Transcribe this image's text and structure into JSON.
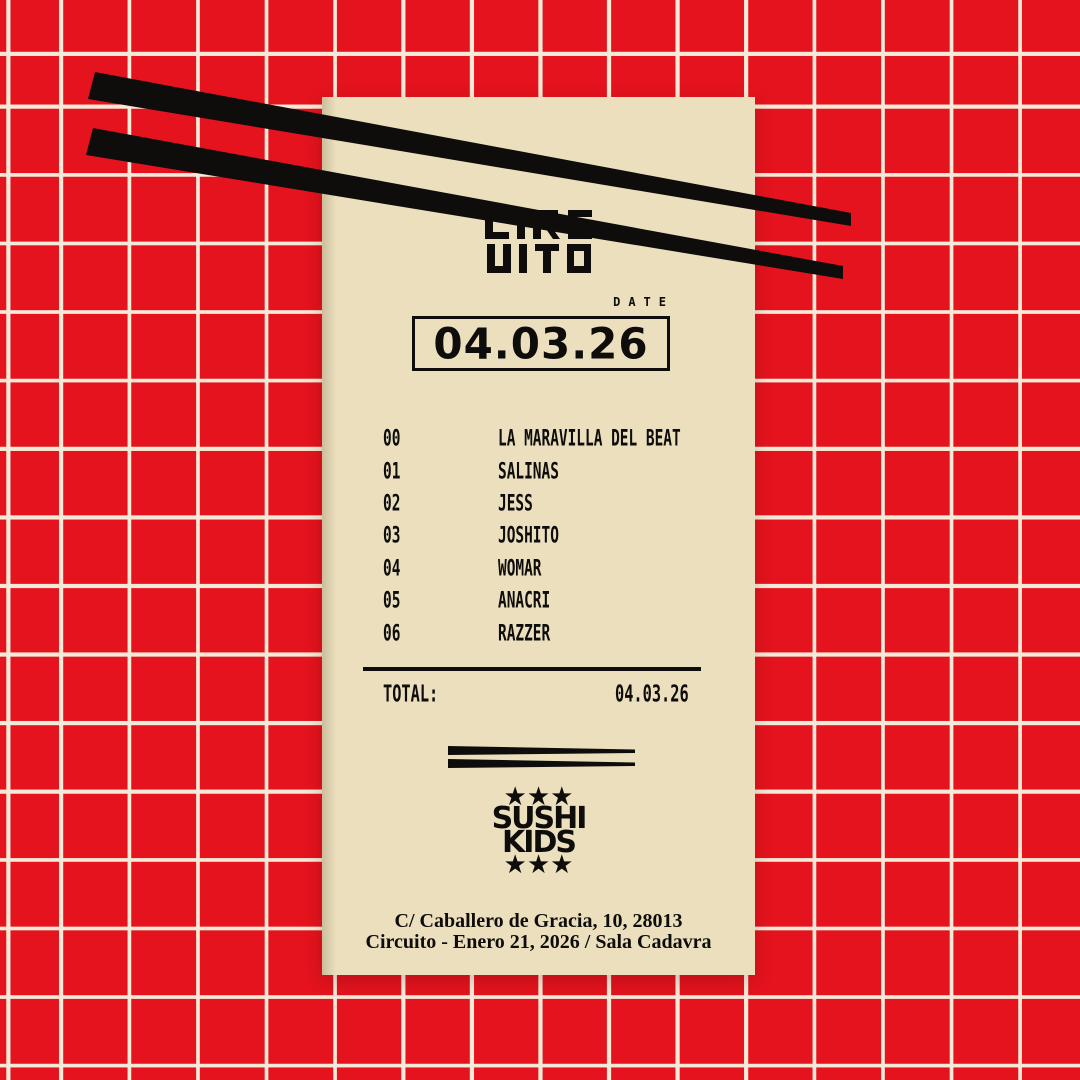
{
  "poster": {
    "brand": {
      "line1": "CIRC",
      "line2": "UITO"
    },
    "date_label": "DATE",
    "date_value": "04.03.26",
    "lineup": [
      {
        "num": "00",
        "name": "LA MARAVILLA DEL BEAT"
      },
      {
        "num": "01",
        "name": "SALINAS"
      },
      {
        "num": "02",
        "name": "JESS"
      },
      {
        "num": "03",
        "name": "JOSHITO"
      },
      {
        "num": "04",
        "name": "WOMAR"
      },
      {
        "num": "05",
        "name": "ANACRI"
      },
      {
        "num": "06",
        "name": "RAZZER"
      }
    ],
    "total_label": "TOTAL:",
    "total_value": "04.03.26",
    "footer_logo": {
      "top_stars": "★★★",
      "line1": "SUSHI",
      "line2": "KIDS",
      "bottom_stars": "★★★"
    },
    "address_line1": "C/ Caballero de Gracia, 10, 28013",
    "address_line2": "Circuito - Enero 21, 2026 / Sala Cadavra",
    "colors": {
      "background_red": "#e5131d",
      "grid_line": "#f5e9d7",
      "receipt": "#ebdfbe",
      "ink": "#0e0d0b"
    }
  }
}
